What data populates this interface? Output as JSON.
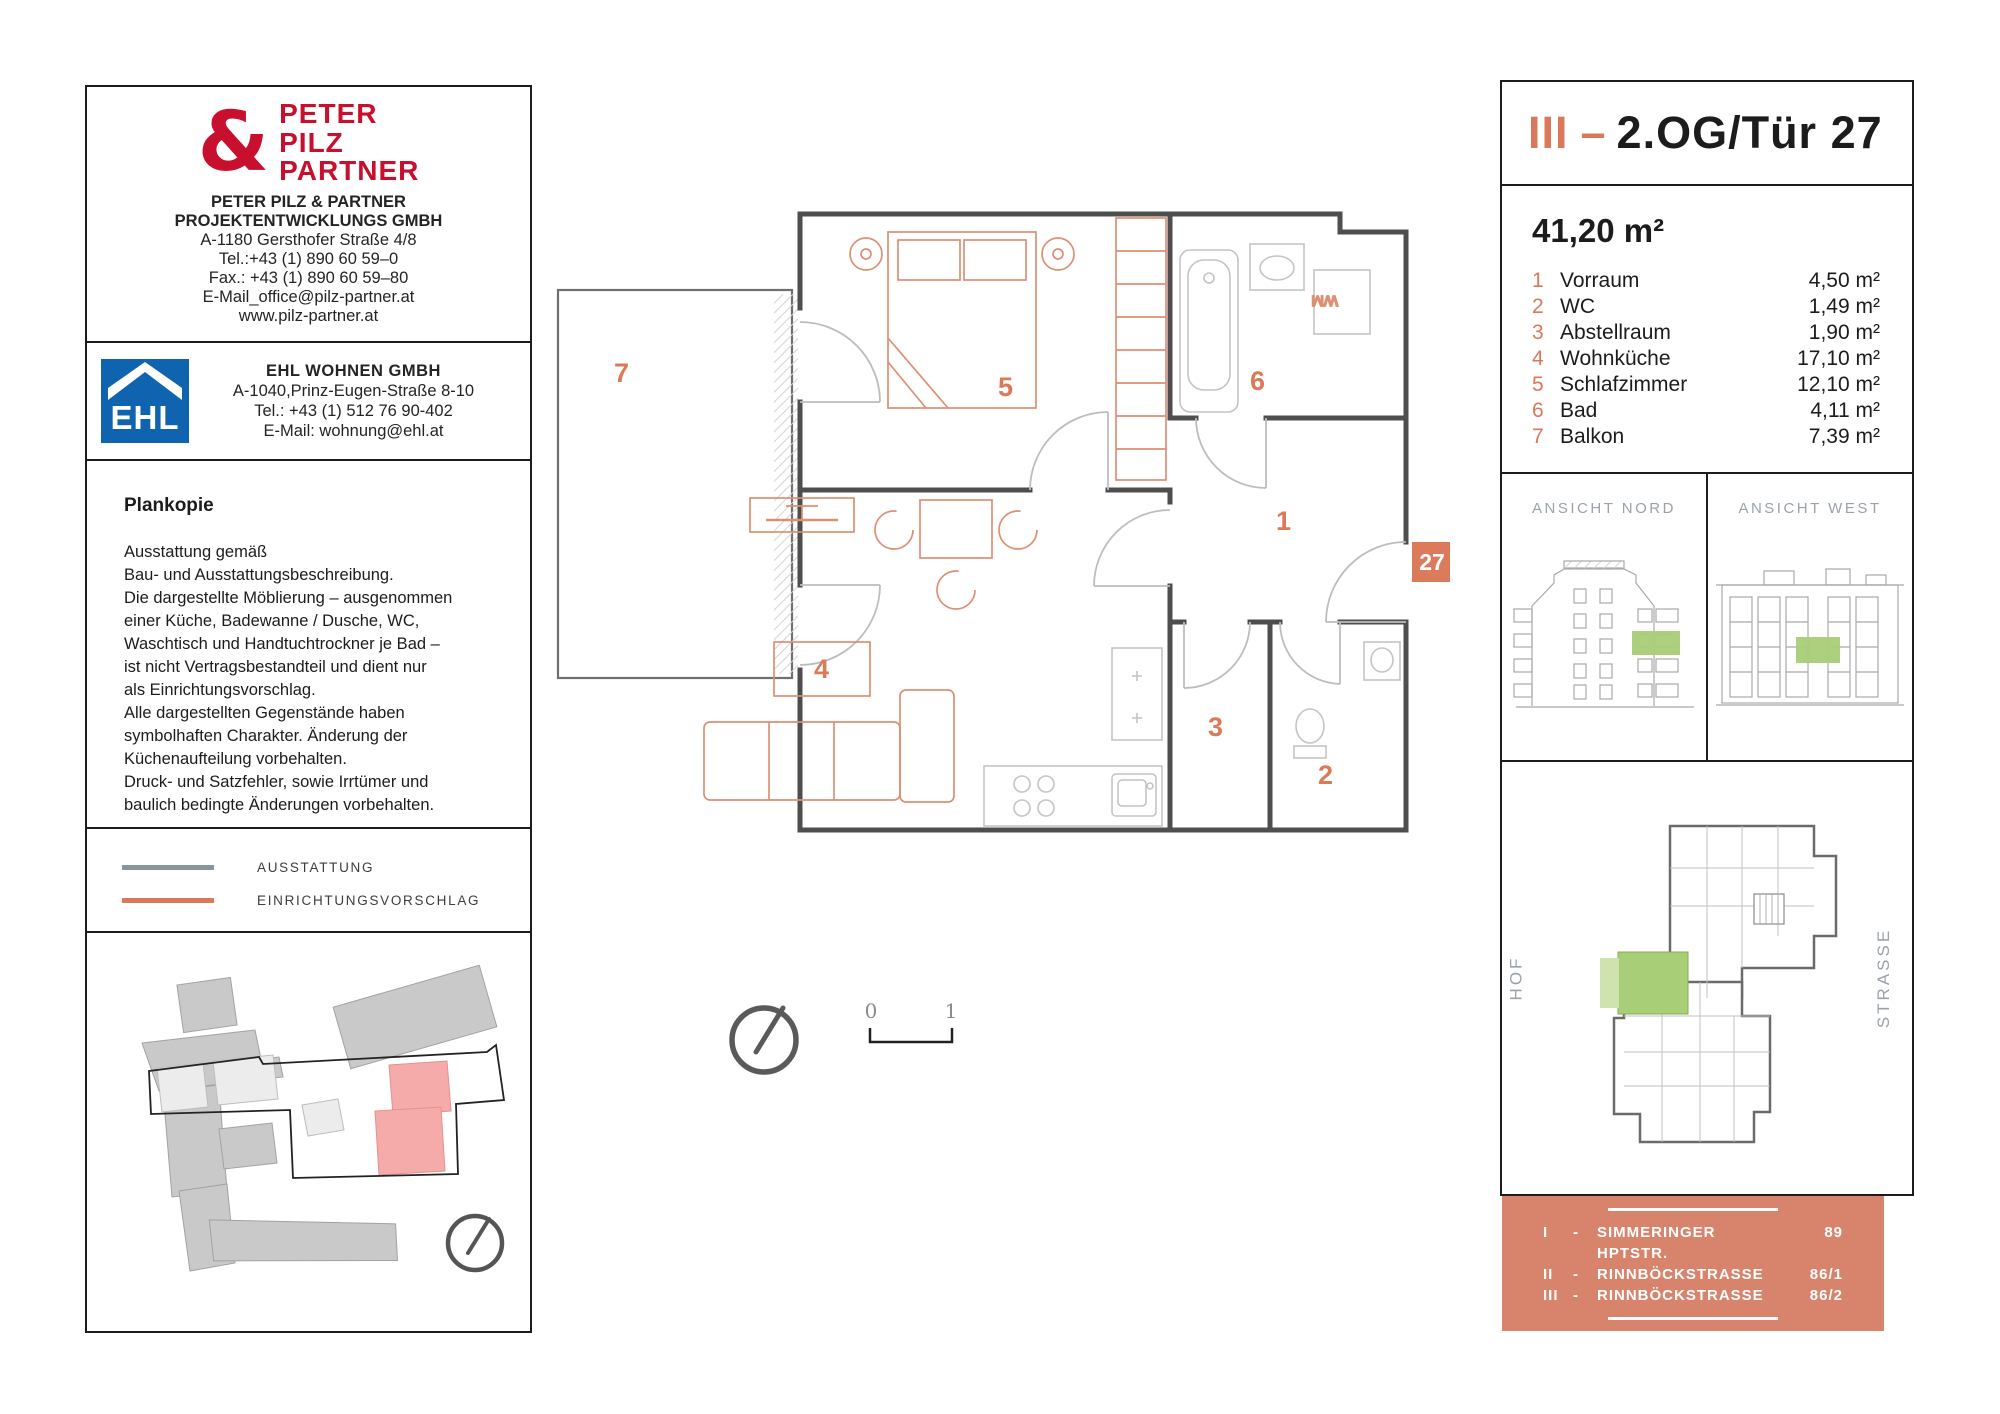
{
  "colors": {
    "accent_orange": "#D9785A",
    "legend_gray": "#8A959D",
    "ehl_blue": "#1063AF",
    "ppp_red": "#C8102E",
    "highlight_green": "#A8CE77",
    "highlight_green_light": "#CFE3AE",
    "highlight_pink": "#F6ABAB",
    "address_box_bg": "#D8846C"
  },
  "left_panel": {
    "ppp_box": {
      "logo_symbol": "&",
      "logo_words": [
        "PETER",
        "PILZ",
        "PARTNER"
      ],
      "lines": [
        "PETER PILZ & PARTNER",
        "PROJEKTENTWICKLUNGS GMBH",
        "A-1180 Gersthofer Straße 4/8",
        "Tel.:+43 (1) 890 60 59–0",
        "Fax.: +43 (1) 890 60 59–80",
        "E-Mail_office@pilz-partner.at",
        "www.pilz-partner.at"
      ]
    },
    "ehl_box": {
      "logo_text": "EHL",
      "lines": [
        "EHL WOHNEN GMBH",
        "A-1040,Prinz-Eugen-Straße 8-10",
        "Tel.: +43 (1) 512 76 90-402",
        "E-Mail: wohnung@ehl.at"
      ]
    },
    "plankopie": {
      "title": "Plankopie",
      "body": [
        "Ausstattung gemäß",
        "Bau- und Ausstattungsbeschreibung.",
        "Die dargestellte Möblierung – ausgenommen",
        "einer Küche, Badewanne / Dusche, WC,",
        "Waschtisch und Handtuchtrockner je Bad –",
        "ist nicht Vertragsbestandteil und dient nur",
        "als Einrichtungsvorschlag.",
        "Alle dargestellten Gegenstände haben",
        "symbolhaften Charakter. Änderung der",
        "Küchenaufteilung vorbehalten.",
        "Druck- und Satzfehler, sowie Irrtümer und",
        "baulich bedingte Änderungen vorbehalten."
      ]
    },
    "legend": {
      "ausstattung_label": "AUSSTATTUNG",
      "einrichtung_label": "EINRICHTUNGSVORSCHLAG"
    }
  },
  "floor_plan": {
    "room_numbers": [
      "1",
      "2",
      "3",
      "4",
      "5",
      "6",
      "7"
    ],
    "unit_badge": "27",
    "wm_label": "WM",
    "scale_start": "0",
    "scale_end": "1"
  },
  "right_panel": {
    "header": {
      "roman": "III",
      "dash": "–",
      "title": "2.OG/Tür 27"
    },
    "total_area": "41,20 m²",
    "rooms": [
      {
        "nr": "1",
        "name": "Vorraum",
        "area": "4,50 m²"
      },
      {
        "nr": "2",
        "name": "WC",
        "area": "1,49 m²"
      },
      {
        "nr": "3",
        "name": "Abstellraum",
        "area": "1,90 m²"
      },
      {
        "nr": "4",
        "name": "Wohnküche",
        "area": "17,10 m²"
      },
      {
        "nr": "5",
        "name": "Schlafzimmer",
        "area": "12,10 m²"
      },
      {
        "nr": "6",
        "name": "Bad",
        "area": "4,11 m²"
      },
      {
        "nr": "7",
        "name": "Balkon",
        "area": "7,39 m²"
      }
    ],
    "elevation_nord_label": "ANSICHT NORD",
    "elevation_west_label": "ANSICHT WEST",
    "overview": {
      "hof_label": "HOF",
      "strasse_label": "STRASSE"
    },
    "address_box": {
      "rows": [
        {
          "roman": "I",
          "dash": "-",
          "street": "SIMMERINGER HPTSTR.",
          "number": "89"
        },
        {
          "roman": "II",
          "dash": "-",
          "street": "RINNBÖCKSTRASSE",
          "number": "86/1"
        },
        {
          "roman": "III",
          "dash": "-",
          "street": "RINNBÖCKSTRASSE",
          "number": "86/2"
        }
      ]
    }
  }
}
